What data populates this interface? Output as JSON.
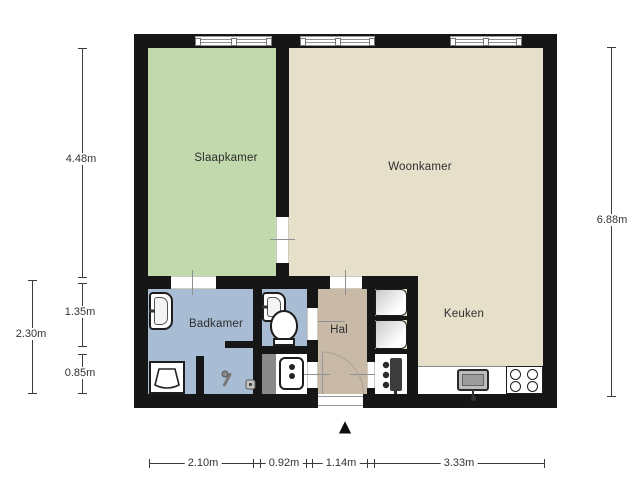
{
  "title": "floor-plan",
  "rooms": {
    "slaapkamer": "Slaapkamer",
    "woonkamer": "Woonkamer",
    "badkamer": "Badkamer",
    "hal": "Hal",
    "keuken": "Keuken"
  },
  "dims": {
    "left_top": "4.48m",
    "left_mid": "1.35m",
    "left_bottom": "0.85m",
    "left_total": "2.30m",
    "right_total": "6.88m",
    "bottom_1": "2.10m",
    "bottom_2": "0.92m",
    "bottom_3": "1.14m",
    "bottom_4": "3.33m"
  },
  "colors": {
    "wall": "#161616",
    "slaapkamer": "#c2d9ad",
    "woonkamer": "#e6dfc9",
    "badkamer": "#a8bcd4",
    "hal": "#c9baa7",
    "shaft": "#8a8a8a"
  },
  "icons": {
    "north_arrow": "▲",
    "fixtures": [
      "washbasin",
      "toilet",
      "washing-machine",
      "water-heater",
      "cv-boiler",
      "kitchen-sink",
      "stove-4-burner",
      "shower-drain",
      "wardrobe"
    ]
  }
}
